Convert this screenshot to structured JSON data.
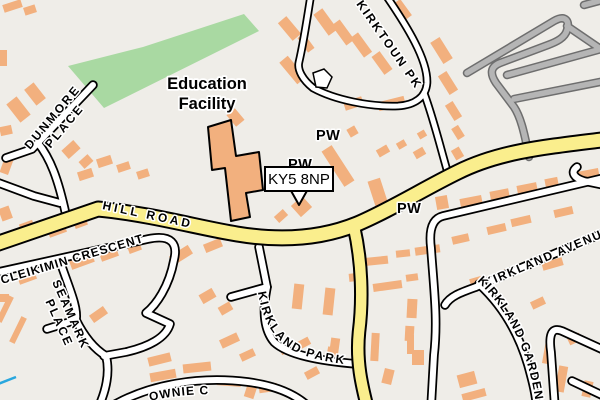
{
  "map": {
    "colors": {
      "background": "#EFEDE8",
      "park": "#A9D9A2",
      "building": "#F2B07E",
      "road_major": "#FAEE8D",
      "road_minor": "#FFFFFF",
      "road_casing": "#000000",
      "road_gray": "#B5B5B5",
      "road_gray_casing": "#6E6E6E",
      "water": "#29A7DE",
      "label_text": "#000000",
      "label_halo": "#FFFFFF"
    },
    "poi": {
      "education_line1": "Education",
      "education_line2": "Facility",
      "pw_1": "PW",
      "pw_2": "PW",
      "pw_3": "PW"
    },
    "callout": {
      "text": "KY5 8NP"
    },
    "roads": {
      "dunmore_1": "DUNMORE",
      "dunmore_2": "PLACE",
      "hill_road": "HILL ROAD",
      "cleikimin_crescent": "CLEIKIMIN CRESCENT",
      "seamark_1": "SEAMARK",
      "seamark_2": "PLACE",
      "kirktoun_pk": "KIRKTOUN PK",
      "kirkland_park": "KIRKLAND PARK",
      "kirkland_avenue": "KIRKLAND AVENUE",
      "kirkland_gardens": "KIRKLAND GARDENS",
      "brownie_partial": "OWNIE C"
    }
  }
}
